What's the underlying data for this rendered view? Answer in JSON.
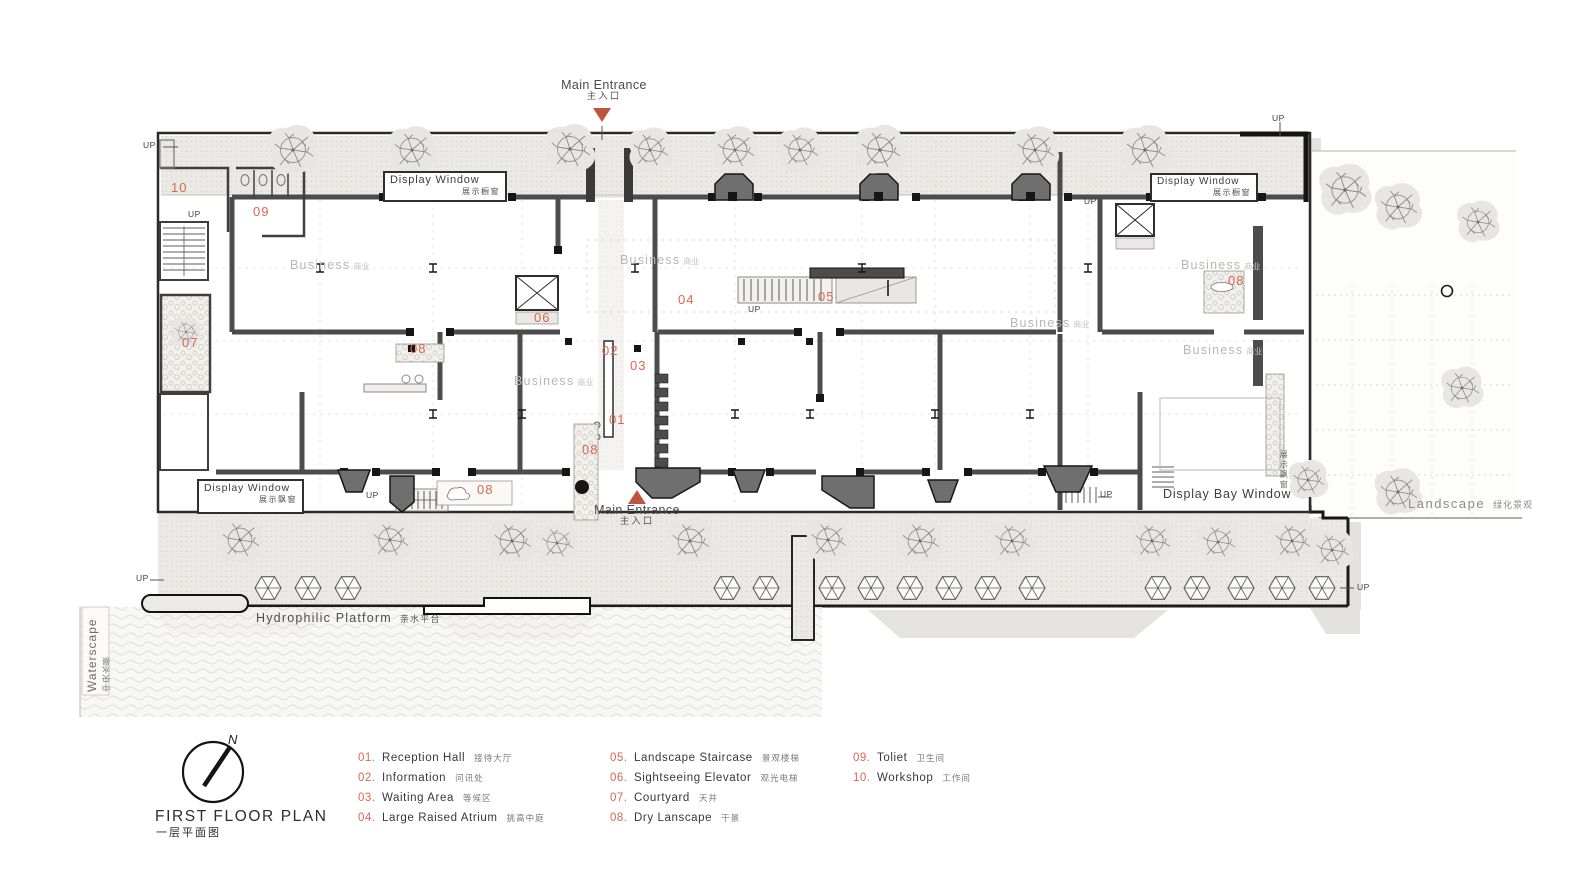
{
  "title": {
    "en": "FIRST FLOOR PLAN",
    "zh": "一层平面图"
  },
  "compass_n": "N",
  "up": "UP",
  "entrance": {
    "en": "Main Entrance",
    "zh": "主入口"
  },
  "labels": {
    "display_window": "Display Window",
    "display_window_zh_shop": "展示橱窗",
    "display_window_zh_bay": "展示飘窗",
    "display_bay_window": "Display Bay Window",
    "business_en": "Business",
    "business_zh": "商业",
    "landscape_en": "Landscape",
    "landscape_zh": "绿化景观",
    "waterscape_en": "Waterscape",
    "waterscape_zh": "中央水景",
    "hydrophilic_en": "Hydrophilic Platform",
    "hydrophilic_zh": "亲水平台"
  },
  "markers": {
    "m01": "01",
    "m02": "02",
    "m03": "03",
    "m04": "04",
    "m05": "05",
    "m06": "06",
    "m07": "07",
    "m08": "08",
    "m09": "09",
    "m10": "10"
  },
  "colors": {
    "accent_triangle": "#bf5540",
    "number_orange": "#d4694f",
    "wall_gray": "#4c4c4c",
    "muted_text": "#b9b7b3"
  },
  "legend": {
    "items": [
      {
        "num": "01.",
        "en": "Reception Hall",
        "zh": "接待大厅"
      },
      {
        "num": "02.",
        "en": "Information",
        "zh": "问讯处"
      },
      {
        "num": "03.",
        "en": "Waiting Area",
        "zh": "等候区"
      },
      {
        "num": "04.",
        "en": "Large Raised Atrium",
        "zh": "挑高中庭"
      },
      {
        "num": "05.",
        "en": "Landscape Staircase",
        "zh": "景观楼梯"
      },
      {
        "num": "06.",
        "en": "Sightseeing Elevator",
        "zh": "观光电梯"
      },
      {
        "num": "07.",
        "en": "Courtyard",
        "zh": "天井"
      },
      {
        "num": "08.",
        "en": "Dry Lanscape",
        "zh": "干景"
      },
      {
        "num": "09.",
        "en": "Toliet",
        "zh": "卫生间"
      },
      {
        "num": "10.",
        "en": "Workshop",
        "zh": "工作间"
      }
    ]
  }
}
